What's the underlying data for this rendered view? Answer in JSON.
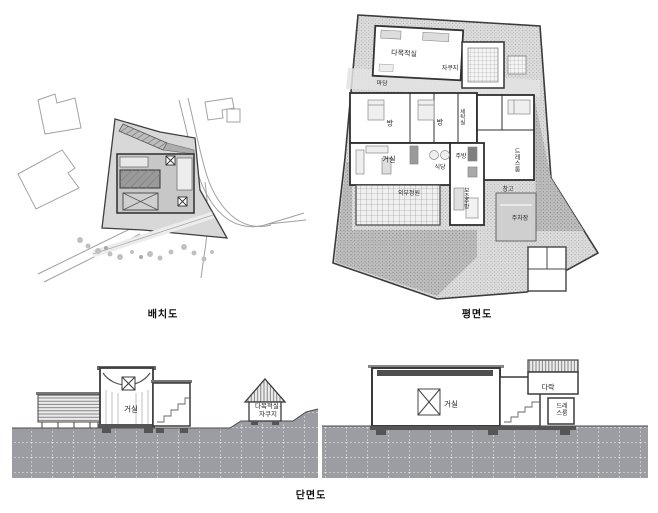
{
  "document": {
    "background": "#ffffff",
    "description_colors": {
      "line": "#3c3c3c",
      "site_fill": "#d8d8d8",
      "building_fill": "#c7c7c7",
      "ground_fill": "#9c9da3",
      "label_text": "#1c1c1c"
    }
  },
  "site_plan": {
    "caption": "배치도"
  },
  "floor_plan": {
    "caption": "평면도",
    "labels": {
      "multipurpose_room": "다목적실",
      "jacuzzi": "자쿠지",
      "yard": "마당",
      "room_left": "방",
      "room_right": "방",
      "laundry": "세탁실",
      "living_room": "거실",
      "dining": "식당",
      "kitchen": "주방",
      "dress_room": "드레스룸",
      "outdoor_garden": "외부정원",
      "aux_kitchen": "보조주방",
      "storage": "창고",
      "parking": "주차장"
    }
  },
  "section": {
    "caption": "단면도",
    "labels": {
      "living_left": "거실",
      "hut": "다목적실·자쿠지",
      "living_right": "거실",
      "attic": "다락",
      "dress_room": "드레스룸"
    }
  }
}
